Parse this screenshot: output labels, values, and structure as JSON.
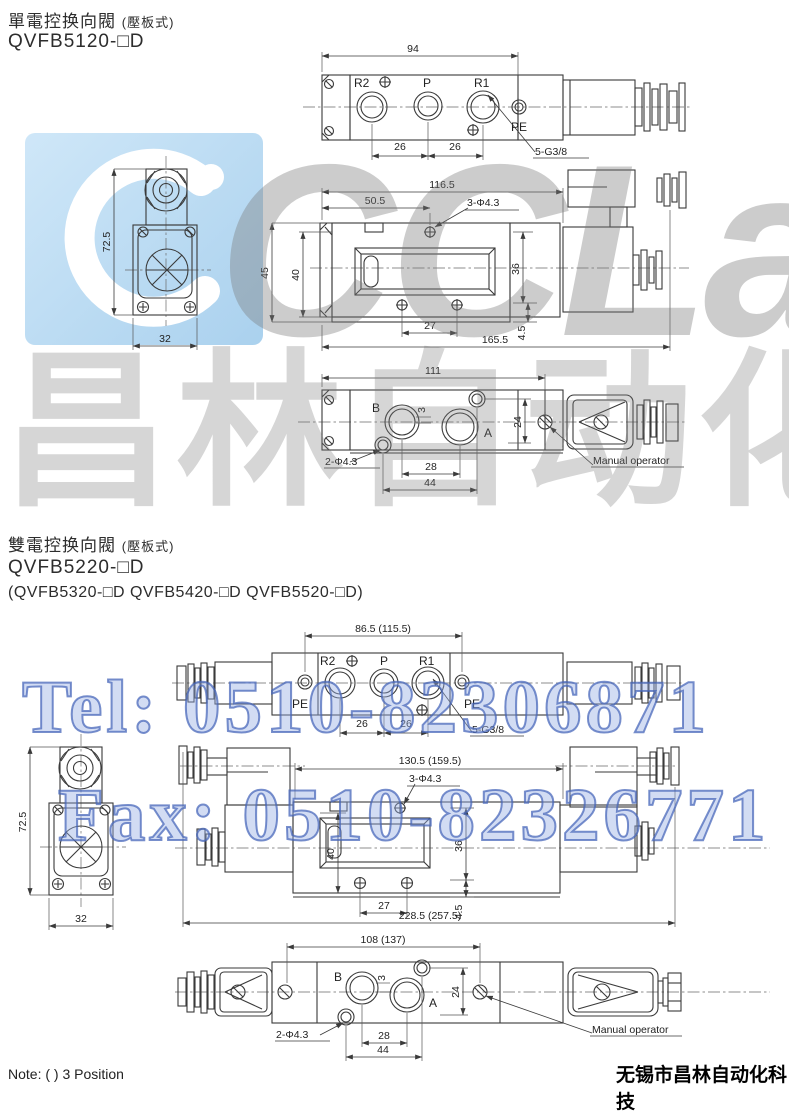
{
  "colors": {
    "accent_blue": "#5b82cf",
    "logo_blue": "#b5d8f0",
    "line": "#3a3a3a",
    "watermark_gray": "#9a9a9a"
  },
  "s1": {
    "title": "單電控换向閥",
    "subtitle": "(壓板式)",
    "model": "QVFB5120-□D",
    "top": {
      "w94": "94",
      "d26a": "26",
      "d26b": "26",
      "r2": "R2",
      "p": "P",
      "r1": "R1",
      "pe": "PE",
      "thread": "5-G3/8"
    },
    "side": {
      "len": "116.5",
      "l1": "50.5",
      "holes": "3-Φ4.3",
      "d45": "45",
      "d40": "40",
      "d36": "36",
      "d45b": "4.5",
      "d27": "27",
      "total": "165.5"
    },
    "end": {
      "h": "72.5",
      "w": "32"
    },
    "bot": {
      "w": "111",
      "b": "B",
      "a": "A",
      "d3": "3",
      "d24": "24",
      "holes": "2-Φ4.3",
      "d28": "28",
      "d44": "44",
      "manual": "Manual operator"
    }
  },
  "s2": {
    "title": "雙電控换向閥",
    "subtitle": "(壓板式)",
    "model": "QVFB5220-□D",
    "models_alt": "(QVFB5320-□D  QVFB5420-□D  QVFB5520-□D)",
    "top": {
      "w": "86.5 (115.5)",
      "d26a": "26",
      "d26b": "26",
      "r2": "R2",
      "p": "P",
      "r1": "R1",
      "pe_l": "PE",
      "pe_r": "PE",
      "thread": "5-G3/8"
    },
    "side": {
      "len": "130.5 (159.5)",
      "holes": "3-Φ4.3",
      "d40": "40",
      "d36": "36",
      "d45b": "4.5",
      "d27": "27",
      "total": "228.5 (257.5)"
    },
    "end": {
      "h": "72.5",
      "w": "32"
    },
    "bot": {
      "w": "108 (137)",
      "b": "B",
      "a": "A",
      "d3": "3",
      "d24": "24",
      "holes": "2-Φ4.3",
      "d28": "28",
      "d44": "44",
      "manual": "Manual operator"
    }
  },
  "watermark": {
    "logo": "CCLair",
    "cn": "昌林自动化",
    "tel": "Tel: 0510-82306871",
    "fax": "Fax: 0510-82326771"
  },
  "footer": {
    "note": "Note: ( ) 3 Position",
    "company": "无锡市昌林自动化科技"
  }
}
